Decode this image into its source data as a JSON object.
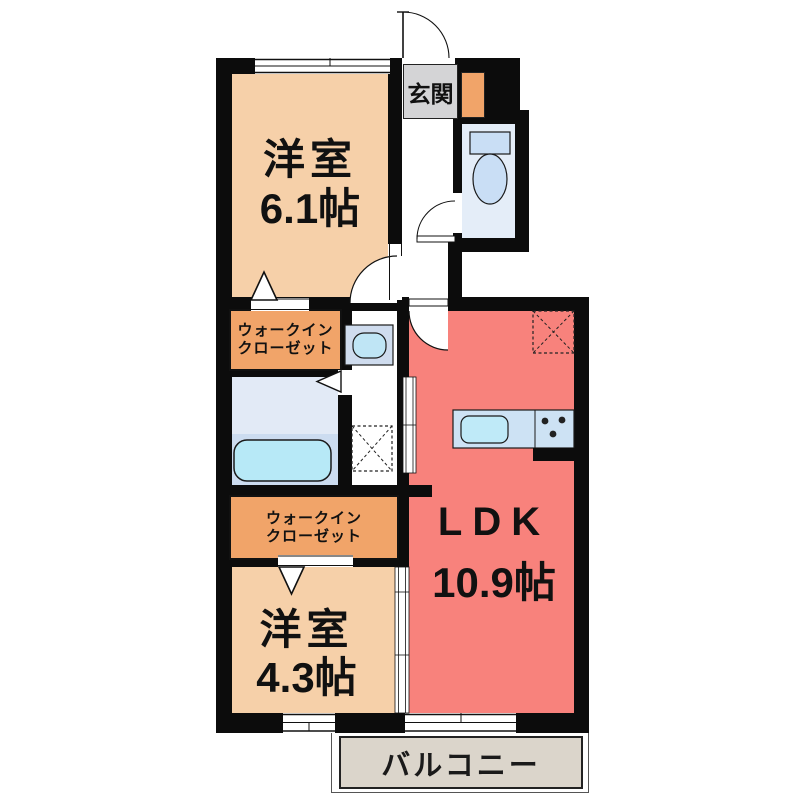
{
  "floor_plan": {
    "type": "japanese-apartment-floorplan",
    "rooms": {
      "bedroom_top": {
        "name": "洋室",
        "size": "6.1帖"
      },
      "ldk": {
        "name": "LDK",
        "size": "10.9帖"
      },
      "bedroom_bottom": {
        "name": "洋室",
        "size": "4.3帖"
      },
      "walk_in_closet_top": {
        "line1": "ウォークイン",
        "line2": "クローゼット"
      },
      "walk_in_closet_bottom": {
        "line1": "ウォークイン",
        "line2": "クローゼット"
      },
      "entrance": {
        "name": "玄関"
      },
      "balcony": {
        "name": "バルコニー"
      }
    },
    "fixtures": {
      "toilet": "toilet",
      "bathtub": "bathtub",
      "washbasin": "washbasin",
      "kitchen_counter": "kitchen-counter-with-sink-and-stove",
      "washing_machine_space": "washing-machine-space-dashed",
      "refrigerator_space": "refrigerator-space-dashed",
      "shoe_cabinet": "shoe-cabinet"
    },
    "colors": {
      "wall": "#0c0c0c",
      "bedroom": "#f6d0a9",
      "ldk": "#f8827c",
      "closet": "#f1a469",
      "balcony": "#dbd5cb",
      "sanitary_blue": "#e2eaf6",
      "bath_floor": "#ccdcf0",
      "water_cyan": "#b7e9f7",
      "fixture_panel": "#cfdcee",
      "entrance_label_bg": "#d4d4d6"
    }
  }
}
